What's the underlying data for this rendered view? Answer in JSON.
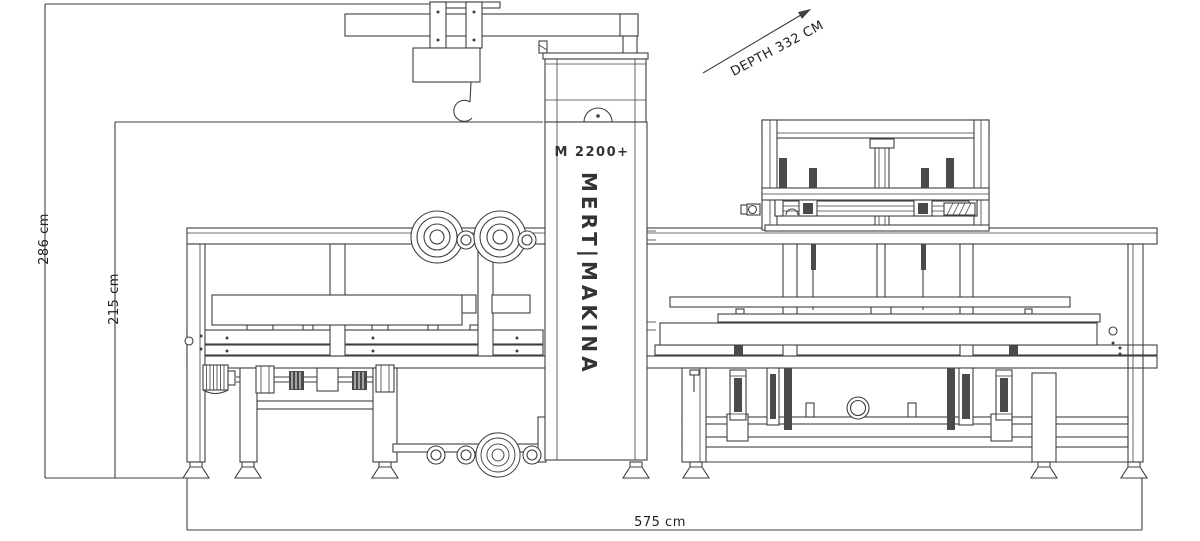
{
  "diagram": {
    "machine_model": "M 2200+",
    "brand": "MERT|MAKINA",
    "line_color": "#3f3f3f",
    "dark_fill": "#4a4a4a",
    "background": "#ffffff",
    "dimensions": {
      "depth_label": "DEPTH 332 CM",
      "overall_height_label": "286 cm",
      "working_height_label": "215 cm",
      "overall_width_label": "575 cm"
    }
  }
}
